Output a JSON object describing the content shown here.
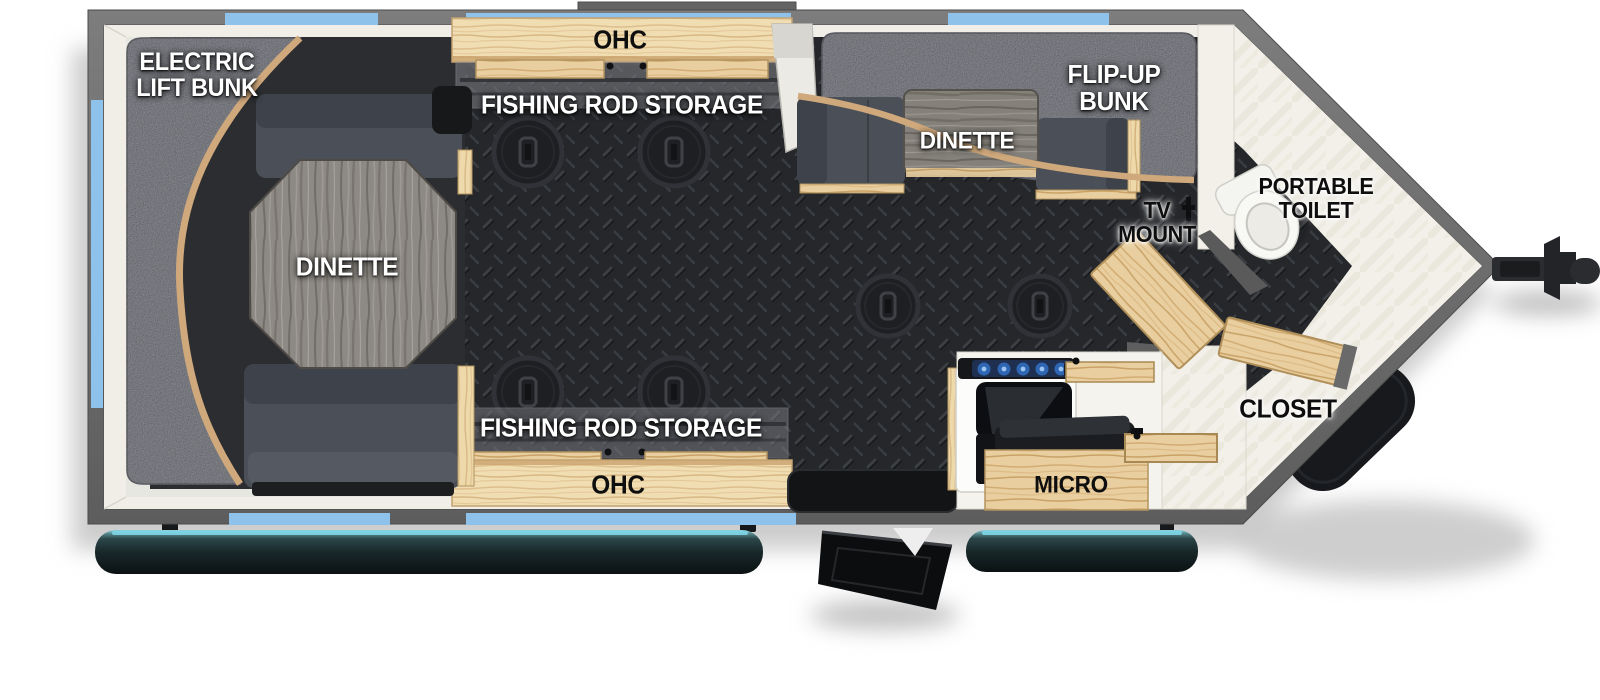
{
  "floorplan": {
    "labels": {
      "electric_lift_bunk": "ELECTRIC\nLIFT BUNK",
      "ohc_top": "OHC",
      "fishing_rod_storage_top": "FISHING ROD STORAGE",
      "flip_up_bunk": "FLIP-UP\nBUNK",
      "dinette_front": "DINETTE",
      "dinette_rear": "DINETTE",
      "tv_mount": "TV\nMOUNT",
      "portable_toilet": "PORTABLE\nTOILET",
      "closet": "CLOSET",
      "micro": "MICRO",
      "fishing_rod_storage_bottom": "FISHING ROD STORAGE",
      "ohc_bottom": "OHC"
    },
    "features": {
      "fishing_hole_count": 6,
      "window_count": 8
    },
    "colors": {
      "wall_gray": "#6b6b6b",
      "window_blue": "#8ec2ea",
      "floor_black": "#25272a",
      "wood_light": "#f0ddb2",
      "wood_trim": "#cfa87c",
      "bunk_gray": "#9fa1a9",
      "cushion_gray": "#4b4f57",
      "cushion_dark": "#3e424a",
      "interior_white": "#f0eee7",
      "rail_cyan": "#7fd6e6"
    }
  }
}
